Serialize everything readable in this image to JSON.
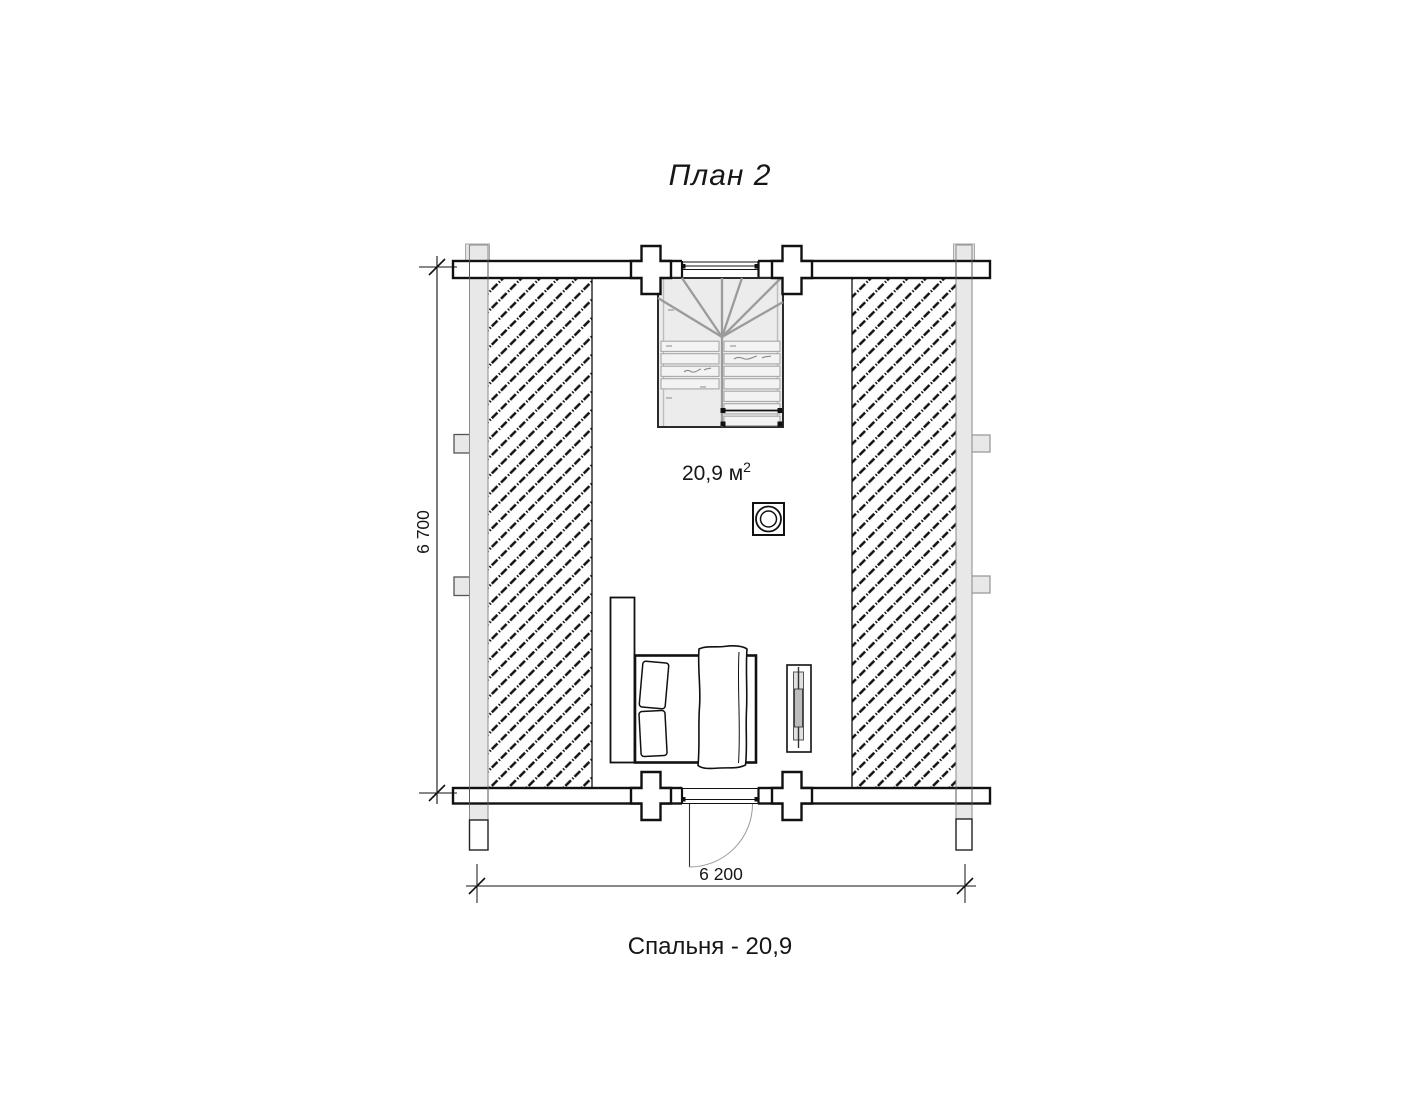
{
  "title": "План 2",
  "plan": {
    "area_value": "20,9 м",
    "area_sup": "2",
    "dim_height": "6 700",
    "dim_width": "6 200"
  },
  "caption": "Спальня - 20,9",
  "colors": {
    "line": "#111111",
    "log_wall_fill": "#e8e8e8",
    "stair_fill": "#ececec",
    "stair_line": "#9b9b9b",
    "hatch": "#111111",
    "background": "#ffffff"
  }
}
